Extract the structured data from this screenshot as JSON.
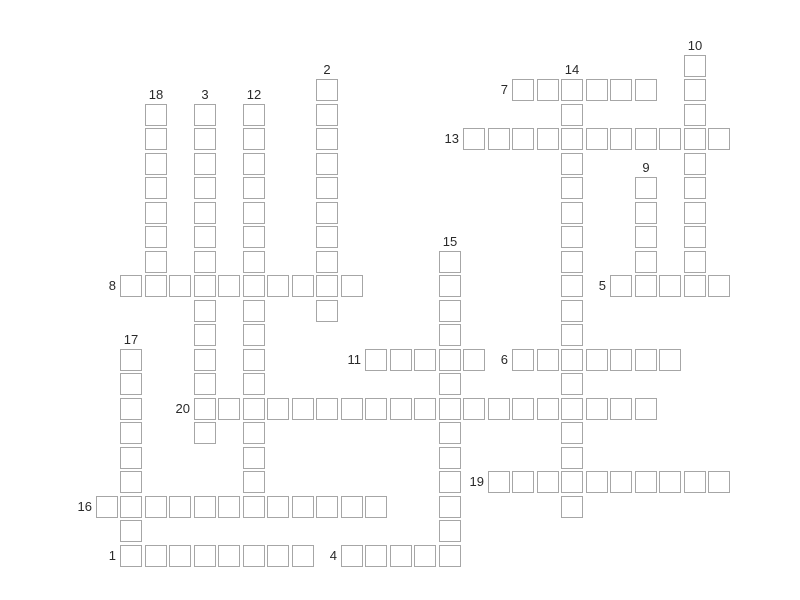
{
  "puzzle": {
    "kind": "crossword-grid-empty",
    "grid": {
      "columns": 26,
      "rows": 21
    },
    "colors": {
      "page_background": "#ffffff",
      "cell_fill": "#ffffff",
      "cell_border": "#a6a6a6",
      "number_text": "#2a2a2a"
    },
    "entries": [
      {
        "number": "1",
        "direction": "across",
        "col": 1,
        "row": 20,
        "length": 8
      },
      {
        "number": "2",
        "direction": "down",
        "col": 9,
        "row": 1,
        "length": 10
      },
      {
        "number": "3",
        "direction": "down",
        "col": 4,
        "row": 2,
        "length": 14
      },
      {
        "number": "4",
        "direction": "across",
        "col": 10,
        "row": 20,
        "length": 5
      },
      {
        "number": "5",
        "direction": "across",
        "col": 21,
        "row": 9,
        "length": 5
      },
      {
        "number": "6",
        "direction": "across",
        "col": 17,
        "row": 12,
        "length": 7
      },
      {
        "number": "7",
        "direction": "across",
        "col": 17,
        "row": 1,
        "length": 6
      },
      {
        "number": "8",
        "direction": "across",
        "col": 1,
        "row": 9,
        "length": 10
      },
      {
        "number": "9",
        "direction": "down",
        "col": 22,
        "row": 5,
        "length": 5
      },
      {
        "number": "10",
        "direction": "down",
        "col": 24,
        "row": 0,
        "length": 10
      },
      {
        "number": "11",
        "direction": "across",
        "col": 11,
        "row": 12,
        "length": 5
      },
      {
        "number": "12",
        "direction": "down",
        "col": 6,
        "row": 2,
        "length": 17
      },
      {
        "number": "13",
        "direction": "across",
        "col": 15,
        "row": 3,
        "length": 11
      },
      {
        "number": "14",
        "direction": "down",
        "col": 19,
        "row": 1,
        "length": 18
      },
      {
        "number": "15",
        "direction": "down",
        "col": 14,
        "row": 8,
        "length": 13
      },
      {
        "number": "16",
        "direction": "across",
        "col": 0,
        "row": 18,
        "length": 12
      },
      {
        "number": "17",
        "direction": "down",
        "col": 1,
        "row": 12,
        "length": 9
      },
      {
        "number": "18",
        "direction": "down",
        "col": 2,
        "row": 2,
        "length": 8
      },
      {
        "number": "19",
        "direction": "across",
        "col": 16,
        "row": 17,
        "length": 10
      },
      {
        "number": "20",
        "direction": "across",
        "col": 4,
        "row": 14,
        "length": 19
      }
    ]
  }
}
